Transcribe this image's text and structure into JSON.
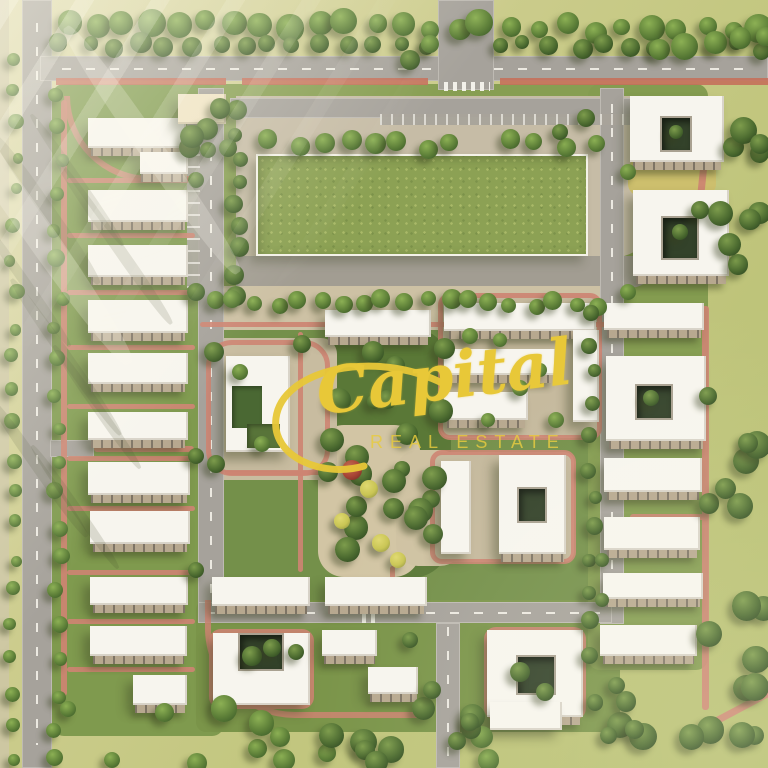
{
  "watermark": {
    "brand": "Capital",
    "tagline": "REAL ESTATE",
    "color": "#e8c838"
  },
  "palette": {
    "meadow": "#c3c780",
    "site_lawn": "#7f9a4e",
    "garden_dark": "#5a7837",
    "road": "#a6a29b",
    "plaza_beige": "#c6bca6",
    "path_pink": "#cd8472",
    "bike_lane_red": "#c5705b",
    "building_white": "#f7f5ee",
    "gate_cream": "#efe3c3",
    "courtyard_green": "#33422a",
    "field_green": "#8ca154",
    "tree_green": "#4c6b30",
    "watermark_gold": "#e8c838"
  },
  "scene": {
    "w": 768,
    "h": 768,
    "lawns": [
      [
        52,
        84,
        172,
        652,
        "#7f9a4e",
        12
      ],
      [
        210,
        84,
        422,
        222,
        "#879e52",
        10
      ],
      [
        210,
        288,
        404,
        330,
        "#74904a",
        10
      ],
      [
        196,
        600,
        424,
        132,
        "#7a9449",
        10
      ],
      [
        588,
        84,
        120,
        586,
        "#849c50",
        12
      ],
      [
        325,
        328,
        126,
        250,
        "#5a7837",
        40
      ],
      [
        214,
        348,
        118,
        124,
        "#617e3c",
        24
      ]
    ],
    "plazas": [
      [
        0,
        0,
        9,
        768,
        "#cdc7a2",
        "0"
      ],
      [
        236,
        96,
        424,
        162,
        "#c6bca6",
        "0 0 50px 0"
      ],
      [
        236,
        256,
        424,
        32,
        "#a29d92",
        "0 0 50px 0"
      ],
      [
        198,
        286,
        414,
        44,
        "#cdc1a4",
        "6px"
      ],
      [
        318,
        425,
        102,
        152,
        "#d2c5a4",
        "26px"
      ],
      [
        396,
        450,
        66,
        116,
        "#cfc2a2",
        "22px"
      ],
      [
        205,
        338,
        132,
        142,
        "#c8bca0",
        "16px"
      ],
      [
        440,
        295,
        160,
        143,
        "#c5b99d",
        "10px"
      ],
      [
        434,
        452,
        140,
        110,
        "#c5b99d",
        "10px"
      ],
      [
        628,
        158,
        88,
        38,
        "#cdbf6d",
        "12px"
      ],
      [
        458,
        6,
        16,
        46,
        "#cfc3a8",
        "4px"
      ]
    ],
    "field": [
      256,
      154,
      332,
      102
    ],
    "roads": [
      [
        22,
        0,
        30,
        768,
        "v",
        1
      ],
      [
        40,
        56,
        728,
        25,
        "h",
        1
      ],
      [
        438,
        0,
        56,
        90,
        "v",
        0
      ],
      [
        230,
        98,
        410,
        20,
        "h",
        0
      ],
      [
        198,
        88,
        26,
        532,
        "v",
        1
      ],
      [
        600,
        88,
        24,
        536,
        "v",
        1
      ],
      [
        198,
        602,
        414,
        21,
        "h",
        1
      ],
      [
        436,
        623,
        24,
        145,
        "v",
        1
      ],
      [
        50,
        440,
        44,
        17,
        "h",
        0
      ]
    ],
    "parking": [
      [
        187,
        118,
        13,
        170,
        "v"
      ],
      [
        380,
        114,
        252,
        11,
        "h"
      ]
    ],
    "red": [
      [
        56,
        78,
        170,
        7
      ],
      [
        242,
        78,
        186,
        7
      ],
      [
        500,
        78,
        268,
        7
      ]
    ],
    "paths": [
      [
        61,
        100,
        6,
        596,
        0
      ],
      [
        67,
        178,
        128,
        5,
        0
      ],
      [
        67,
        233,
        128,
        5,
        0
      ],
      [
        67,
        290,
        128,
        5,
        0
      ],
      [
        67,
        345,
        128,
        5,
        0
      ],
      [
        67,
        404,
        128,
        5,
        0
      ],
      [
        67,
        456,
        128,
        5,
        0
      ],
      [
        67,
        506,
        128,
        5,
        0
      ],
      [
        67,
        570,
        128,
        5,
        0
      ],
      [
        67,
        619,
        128,
        5,
        0
      ],
      [
        67,
        667,
        128,
        5,
        0
      ],
      [
        94,
        446,
        100,
        6,
        0
      ],
      [
        200,
        322,
        410,
        5,
        0
      ],
      [
        298,
        332,
        5,
        240,
        0
      ],
      [
        225,
        470,
        108,
        5,
        0
      ],
      [
        390,
        566,
        5,
        38,
        0
      ],
      [
        702,
        306,
        7,
        404,
        0
      ],
      [
        630,
        436,
        76,
        6,
        0
      ],
      [
        630,
        514,
        76,
        6,
        0
      ],
      [
        708,
        690,
        120,
        7,
        -28
      ],
      [
        700,
        96,
        7,
        146,
        6
      ],
      [
        640,
        246,
        70,
        6,
        0
      ]
    ],
    "rings": [
      [
        206,
        340,
        124,
        136,
        26
      ],
      [
        438,
        293,
        164,
        147,
        12
      ],
      [
        430,
        450,
        146,
        114,
        12
      ],
      [
        484,
        627,
        102,
        93,
        12
      ],
      [
        209,
        629,
        105,
        80,
        12
      ]
    ],
    "arcs": [
      [
        64,
        96,
        132,
        86
      ],
      [
        205,
        600,
        215,
        118
      ]
    ],
    "crosswalks": [
      [
        444,
        82,
        46,
        9,
        "h"
      ],
      [
        362,
        602,
        17,
        21,
        "h"
      ]
    ],
    "buildings": [
      {
        "r": [
          88,
          118,
          98,
          30
        ],
        "skirt": 1
      },
      {
        "r": [
          140,
          152,
          48,
          22
        ],
        "skirt": 1
      },
      {
        "r": [
          88,
          190,
          100,
          32
        ],
        "skirt": 1
      },
      {
        "r": [
          88,
          245,
          100,
          32
        ],
        "skirt": 1
      },
      {
        "r": [
          88,
          300,
          100,
          33
        ],
        "skirt": 1
      },
      {
        "r": [
          88,
          353,
          100,
          31
        ],
        "skirt": 1
      },
      {
        "r": [
          88,
          412,
          100,
          28
        ],
        "skirt": 1
      },
      {
        "r": [
          88,
          462,
          102,
          33
        ],
        "skirt": 1
      },
      {
        "r": [
          90,
          511,
          100,
          33
        ],
        "skirt": 1
      },
      {
        "r": [
          90,
          577,
          98,
          28
        ],
        "skirt": 1
      },
      {
        "r": [
          90,
          626,
          97,
          30
        ],
        "skirt": 1
      },
      {
        "r": [
          133,
          675,
          54,
          30
        ],
        "skirt": 1
      },
      {
        "r": [
          325,
          310,
          106,
          27
        ],
        "skirt": 1
      },
      {
        "r": [
          444,
          303,
          152,
          28
        ],
        "skirt": 1
      },
      {
        "r": [
          444,
          349,
          112,
          26
        ],
        "skirt": 1
      },
      {
        "r": [
          444,
          392,
          84,
          28
        ],
        "skirt": 1
      },
      {
        "r": [
          573,
          330,
          26,
          92
        ]
      },
      {
        "r": [
          604,
          303,
          100,
          27
        ],
        "skirt": 1
      },
      {
        "r": [
          630,
          96,
          94,
          66
        ],
        "court": [
          660,
          116,
          32,
          36
        ],
        "skirt": 1,
        "n": "courtyard-building"
      },
      {
        "r": [
          633,
          190,
          96,
          86
        ],
        "court": [
          661,
          216,
          38,
          44
        ],
        "skirt": 1,
        "n": "courtyard-building"
      },
      {
        "r": [
          606,
          356,
          100,
          85
        ],
        "court": [
          635,
          384,
          38,
          36
        ],
        "skirt": 1,
        "n": "courtyard-building"
      },
      {
        "r": [
          604,
          458,
          98,
          34
        ],
        "skirt": 1
      },
      {
        "r": [
          604,
          517,
          96,
          33
        ],
        "skirt": 1
      },
      {
        "r": [
          603,
          573,
          100,
          26
        ],
        "skirt": 1
      },
      {
        "r": [
          600,
          625,
          97,
          31
        ],
        "skirt": 1
      },
      {
        "r": [
          226,
          356,
          64,
          96
        ],
        "n": "community-building",
        "g": [
          [
            232,
            386,
            30,
            42,
            "#4a6833"
          ],
          [
            247,
            424,
            33,
            24,
            "#587439"
          ]
        ]
      },
      {
        "r": [
          441,
          461,
          30,
          93
        ]
      },
      {
        "r": [
          499,
          455,
          67,
          99
        ],
        "court": [
          517,
          487,
          30,
          36
        ],
        "skirt": 1,
        "n": "courtyard-building"
      },
      {
        "r": [
          212,
          577,
          98,
          29
        ],
        "skirt": 1
      },
      {
        "r": [
          325,
          577,
          102,
          29
        ],
        "skirt": 1
      },
      {
        "r": [
          213,
          633,
          97,
          72
        ],
        "court": [
          238,
          633,
          46,
          38
        ],
        "n": "courtyard-building"
      },
      {
        "r": [
          322,
          630,
          55,
          26
        ],
        "skirt": 1
      },
      {
        "r": [
          368,
          667,
          50,
          27
        ],
        "skirt": 1
      },
      {
        "r": [
          487,
          630,
          96,
          87
        ],
        "court": [
          516,
          655,
          40,
          40
        ],
        "skirt": 1,
        "n": "courtyard-building"
      },
      {
        "r": [
          490,
          702,
          72,
          28
        ]
      },
      {
        "r": [
          178,
          94,
          48,
          30
        ],
        "c": "cream",
        "n": "gate-canopy"
      }
    ],
    "trees": {
      "rows": [
        [
          70,
          22,
          760,
          30,
          26,
          8,
          15,
          "mid",
          11
        ],
        [
          60,
          47,
          426,
          47,
          15,
          7,
          11,
          "dark",
          12
        ],
        [
          500,
          47,
          764,
          47,
          11,
          7,
          11,
          "dark",
          13
        ],
        [
          14,
          60,
          14,
          758,
          22,
          5,
          8,
          "mid",
          14
        ],
        [
          58,
          96,
          58,
          760,
          21,
          6,
          9,
          "mid",
          15
        ],
        [
          236,
          114,
          236,
          296,
          9,
          7,
          11,
          "dark",
          16
        ],
        [
          214,
          303,
          598,
          303,
          19,
          7,
          10,
          "mid",
          17
        ],
        [
          592,
          312,
          592,
          652,
          12,
          6,
          9,
          "dark",
          18
        ],
        [
          272,
          141,
          452,
          147,
          8,
          8,
          12,
          "mid",
          19
        ],
        [
          508,
          140,
          592,
          146,
          4,
          8,
          11,
          "mid",
          20
        ],
        [
          660,
          50,
          764,
          38,
          5,
          9,
          14,
          "mid",
          21
        ]
      ],
      "scatter": [
        [
          706,
          320,
          60,
          440,
          14,
          8,
          15,
          "dark",
          31
        ],
        [
          720,
          90,
          46,
          220,
          9,
          9,
          14,
          "dark",
          32
        ],
        [
          330,
          335,
          115,
          235,
          22,
          7,
          13,
          "dark",
          33
        ],
        [
          60,
          700,
          440,
          64,
          12,
          8,
          15,
          "mid",
          34
        ],
        [
          330,
          706,
          160,
          58,
          9,
          9,
          14,
          "dark",
          35
        ],
        [
          592,
          660,
          170,
          80,
          10,
          8,
          14,
          "dark",
          36
        ],
        [
          180,
          98,
          54,
          52,
          6,
          8,
          12,
          "dark",
          37
        ]
      ],
      "single": [
        [
          196,
          180,
          8,
          "dark"
        ],
        [
          196,
          292,
          9,
          "dark"
        ],
        [
          196,
          456,
          8,
          "dark"
        ],
        [
          196,
          570,
          8,
          "dark"
        ],
        [
          352,
          470,
          10,
          "red"
        ],
        [
          369,
          489,
          9,
          "yellow"
        ],
        [
          342,
          521,
          8,
          "yellow"
        ],
        [
          381,
          543,
          9,
          "yellow"
        ],
        [
          398,
          560,
          8,
          "yellow"
        ],
        [
          214,
          352,
          10,
          "dark"
        ],
        [
          302,
          344,
          9,
          "dark"
        ],
        [
          216,
          464,
          9,
          "dark"
        ],
        [
          328,
          472,
          10,
          "dark"
        ],
        [
          470,
          336,
          8,
          "mid"
        ],
        [
          520,
          388,
          8,
          "mid"
        ],
        [
          556,
          420,
          8,
          "mid"
        ],
        [
          488,
          420,
          7,
          "mid"
        ],
        [
          500,
          340,
          7,
          "mid"
        ],
        [
          540,
          370,
          7,
          "mid"
        ],
        [
          520,
          672,
          10,
          "dark"
        ],
        [
          545,
          692,
          9,
          "dark"
        ],
        [
          252,
          656,
          10,
          "dark"
        ],
        [
          272,
          648,
          9,
          "dark"
        ],
        [
          296,
          652,
          8,
          "dark"
        ],
        [
          628,
          172,
          8,
          "mid"
        ],
        [
          700,
          210,
          9,
          "dark"
        ],
        [
          628,
          292,
          8,
          "mid"
        ],
        [
          432,
          690,
          9,
          "dark"
        ],
        [
          470,
          722,
          9,
          "dark"
        ],
        [
          410,
          640,
          8,
          "dark"
        ],
        [
          586,
          118,
          9,
          "dark"
        ],
        [
          560,
          132,
          8,
          "dark"
        ],
        [
          410,
          60,
          10,
          "dark"
        ],
        [
          430,
          44,
          9,
          "mid"
        ],
        [
          240,
          372,
          8,
          "mid"
        ],
        [
          262,
          444,
          8,
          "mid"
        ],
        [
          602,
          560,
          7,
          "dark"
        ],
        [
          602,
          600,
          7,
          "dark"
        ],
        [
          651,
          398,
          8,
          "dark"
        ],
        [
          676,
          132,
          7,
          "dark"
        ],
        [
          680,
          232,
          8,
          "dark"
        ]
      ]
    },
    "streaks": [
      [
        40,
        120,
        14,
        180,
        -35,
        "dark"
      ],
      [
        72,
        100,
        10,
        160,
        -35,
        "dark"
      ],
      [
        108,
        142,
        12,
        200,
        -35,
        "dark"
      ],
      [
        22,
        210,
        10,
        150,
        -35,
        "dark"
      ],
      [
        60,
        262,
        12,
        190,
        -35,
        "dark"
      ],
      [
        92,
        332,
        10,
        150,
        -35,
        "dark"
      ],
      [
        32,
        382,
        12,
        170,
        -35,
        "dark"
      ],
      [
        70,
        432,
        10,
        150,
        -35,
        "dark"
      ],
      [
        0,
        0,
        30,
        400,
        -35,
        "light"
      ],
      [
        140,
        0,
        24,
        300,
        -35,
        "light"
      ]
    ]
  }
}
